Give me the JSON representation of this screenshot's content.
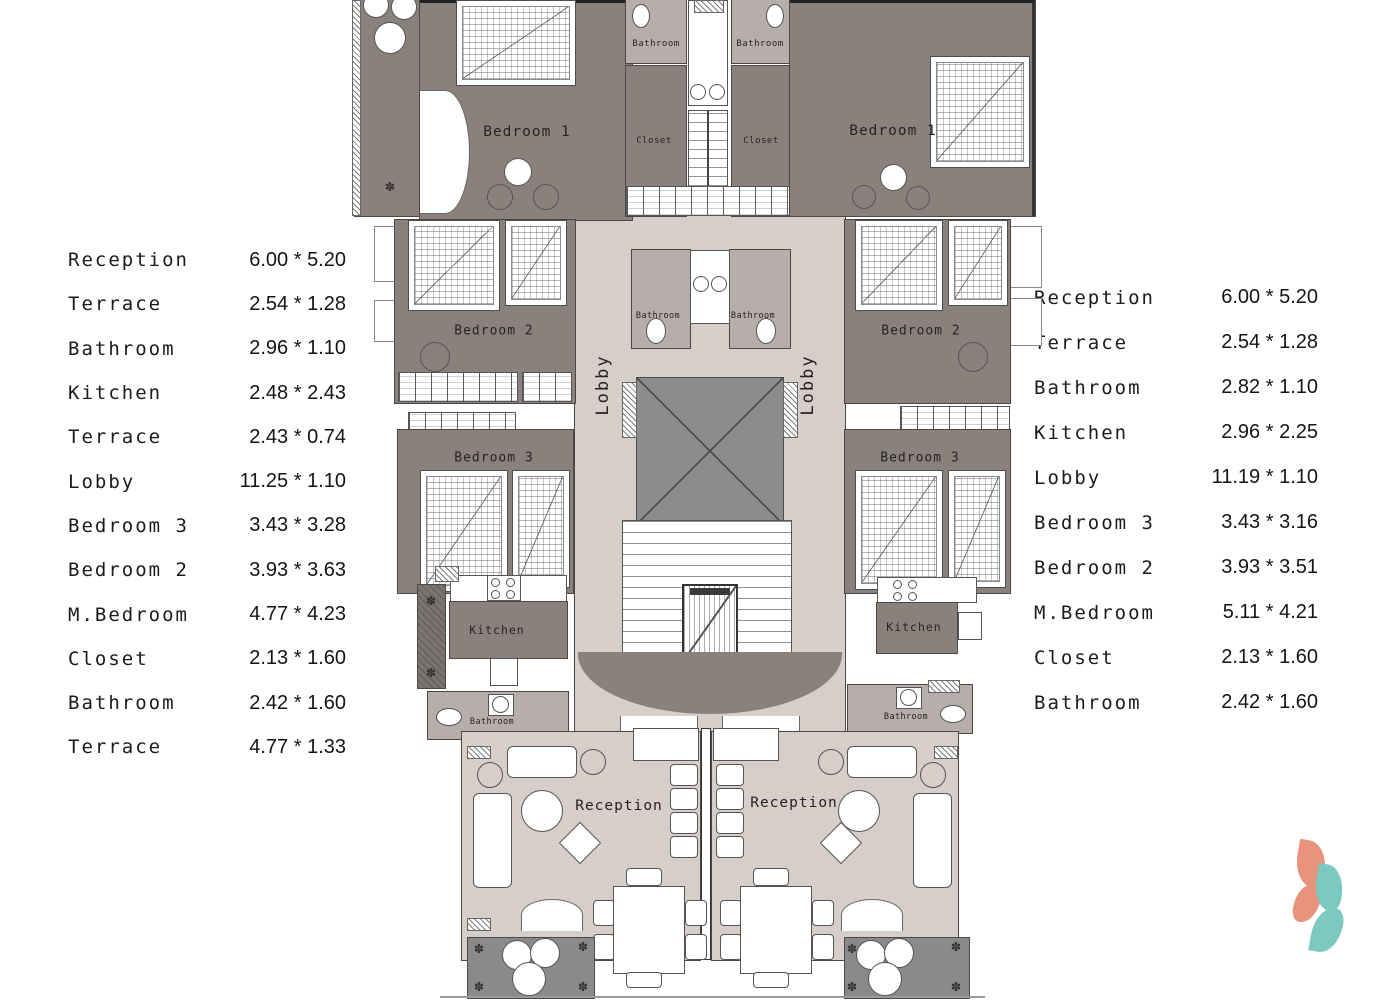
{
  "left_table": {
    "rows": [
      {
        "name": "Reception",
        "dim": "6.00 * 5.20"
      },
      {
        "name": "Terrace",
        "dim": "2.54 * 1.28"
      },
      {
        "name": "Bathroom",
        "dim": "2.96 * 1.10"
      },
      {
        "name": "Kitchen",
        "dim": "2.48 * 2.43"
      },
      {
        "name": "Terrace",
        "dim": "2.43 * 0.74"
      },
      {
        "name": "Lobby",
        "dim": "11.25 * 1.10"
      },
      {
        "name": "Bedroom 3",
        "dim": "3.43 * 3.28"
      },
      {
        "name": "Bedroom 2",
        "dim": "3.93 * 3.63"
      },
      {
        "name": "M.Bedroom",
        "dim": "4.77 * 4.23"
      },
      {
        "name": "Closet",
        "dim": "2.13 * 1.60"
      },
      {
        "name": "Bathroom",
        "dim": "2.42 * 1.60"
      },
      {
        "name": "Terrace",
        "dim": "4.77 * 1.33"
      }
    ]
  },
  "right_table": {
    "rows": [
      {
        "name": "Reception",
        "dim": "6.00 * 5.20"
      },
      {
        "name": "Terrace",
        "dim": "2.54 * 1.28"
      },
      {
        "name": "Bathroom",
        "dim": "2.82 * 1.10"
      },
      {
        "name": "Kitchen",
        "dim": "2.96 * 2.25"
      },
      {
        "name": "Lobby",
        "dim": "11.19 * 1.10"
      },
      {
        "name": "Bedroom 3",
        "dim": "3.43 * 3.16"
      },
      {
        "name": "Bedroom 2",
        "dim": "3.93 * 3.51"
      },
      {
        "name": "M.Bedroom",
        "dim": "5.11 * 4.21"
      },
      {
        "name": "Closet",
        "dim": "2.13 * 1.60"
      },
      {
        "name": "Bathroom",
        "dim": "2.42 * 1.60"
      }
    ]
  },
  "plan": {
    "labels": {
      "bedroom1": "Bedroom 1",
      "bedroom2": "Bedroom 2",
      "bedroom3": "Bedroom 3",
      "bathroom": "Bathroom",
      "closet": "Closet",
      "lobby": "Lobby",
      "kitchen": "Kitchen",
      "reception": "Reception"
    }
  },
  "icons": {
    "plant": "✽"
  },
  "colors": {
    "room_dark": "#8a817c",
    "bathroom_gray": "#b7adaa",
    "lobby_light": "#d7cdc9",
    "shaft_gray": "#8d8d8d",
    "terrace_dark": "#8a8a8a",
    "logo_coral": "#e8937e",
    "logo_teal": "#7cc9c1"
  }
}
